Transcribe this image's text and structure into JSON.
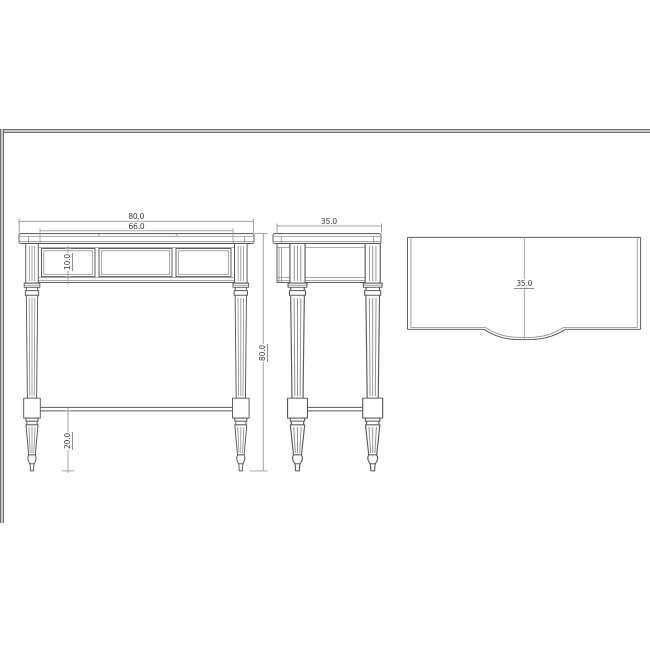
{
  "drawing": {
    "title": "console table three-view technical drawing",
    "views": {
      "front": {
        "name": "front elevation",
        "dim_overall_width": "80.0",
        "dim_inner_width": "66.0",
        "dim_apron_height": "10.0",
        "dim_overall_height": "80.0",
        "dim_stretcher_height": "20.0"
      },
      "side": {
        "name": "side elevation",
        "dim_depth": "35.0"
      },
      "top": {
        "name": "plan view",
        "dim_depth": "35.0"
      }
    },
    "colors": {
      "background": "#ffffff",
      "outline": "#585858",
      "fine_line": "#8f8f8f",
      "dimension_line": "#9b9b9b",
      "text": "#3a3a3a",
      "frame_dark": "#6f6f6f",
      "frame_light": "#c9c9c9"
    }
  }
}
